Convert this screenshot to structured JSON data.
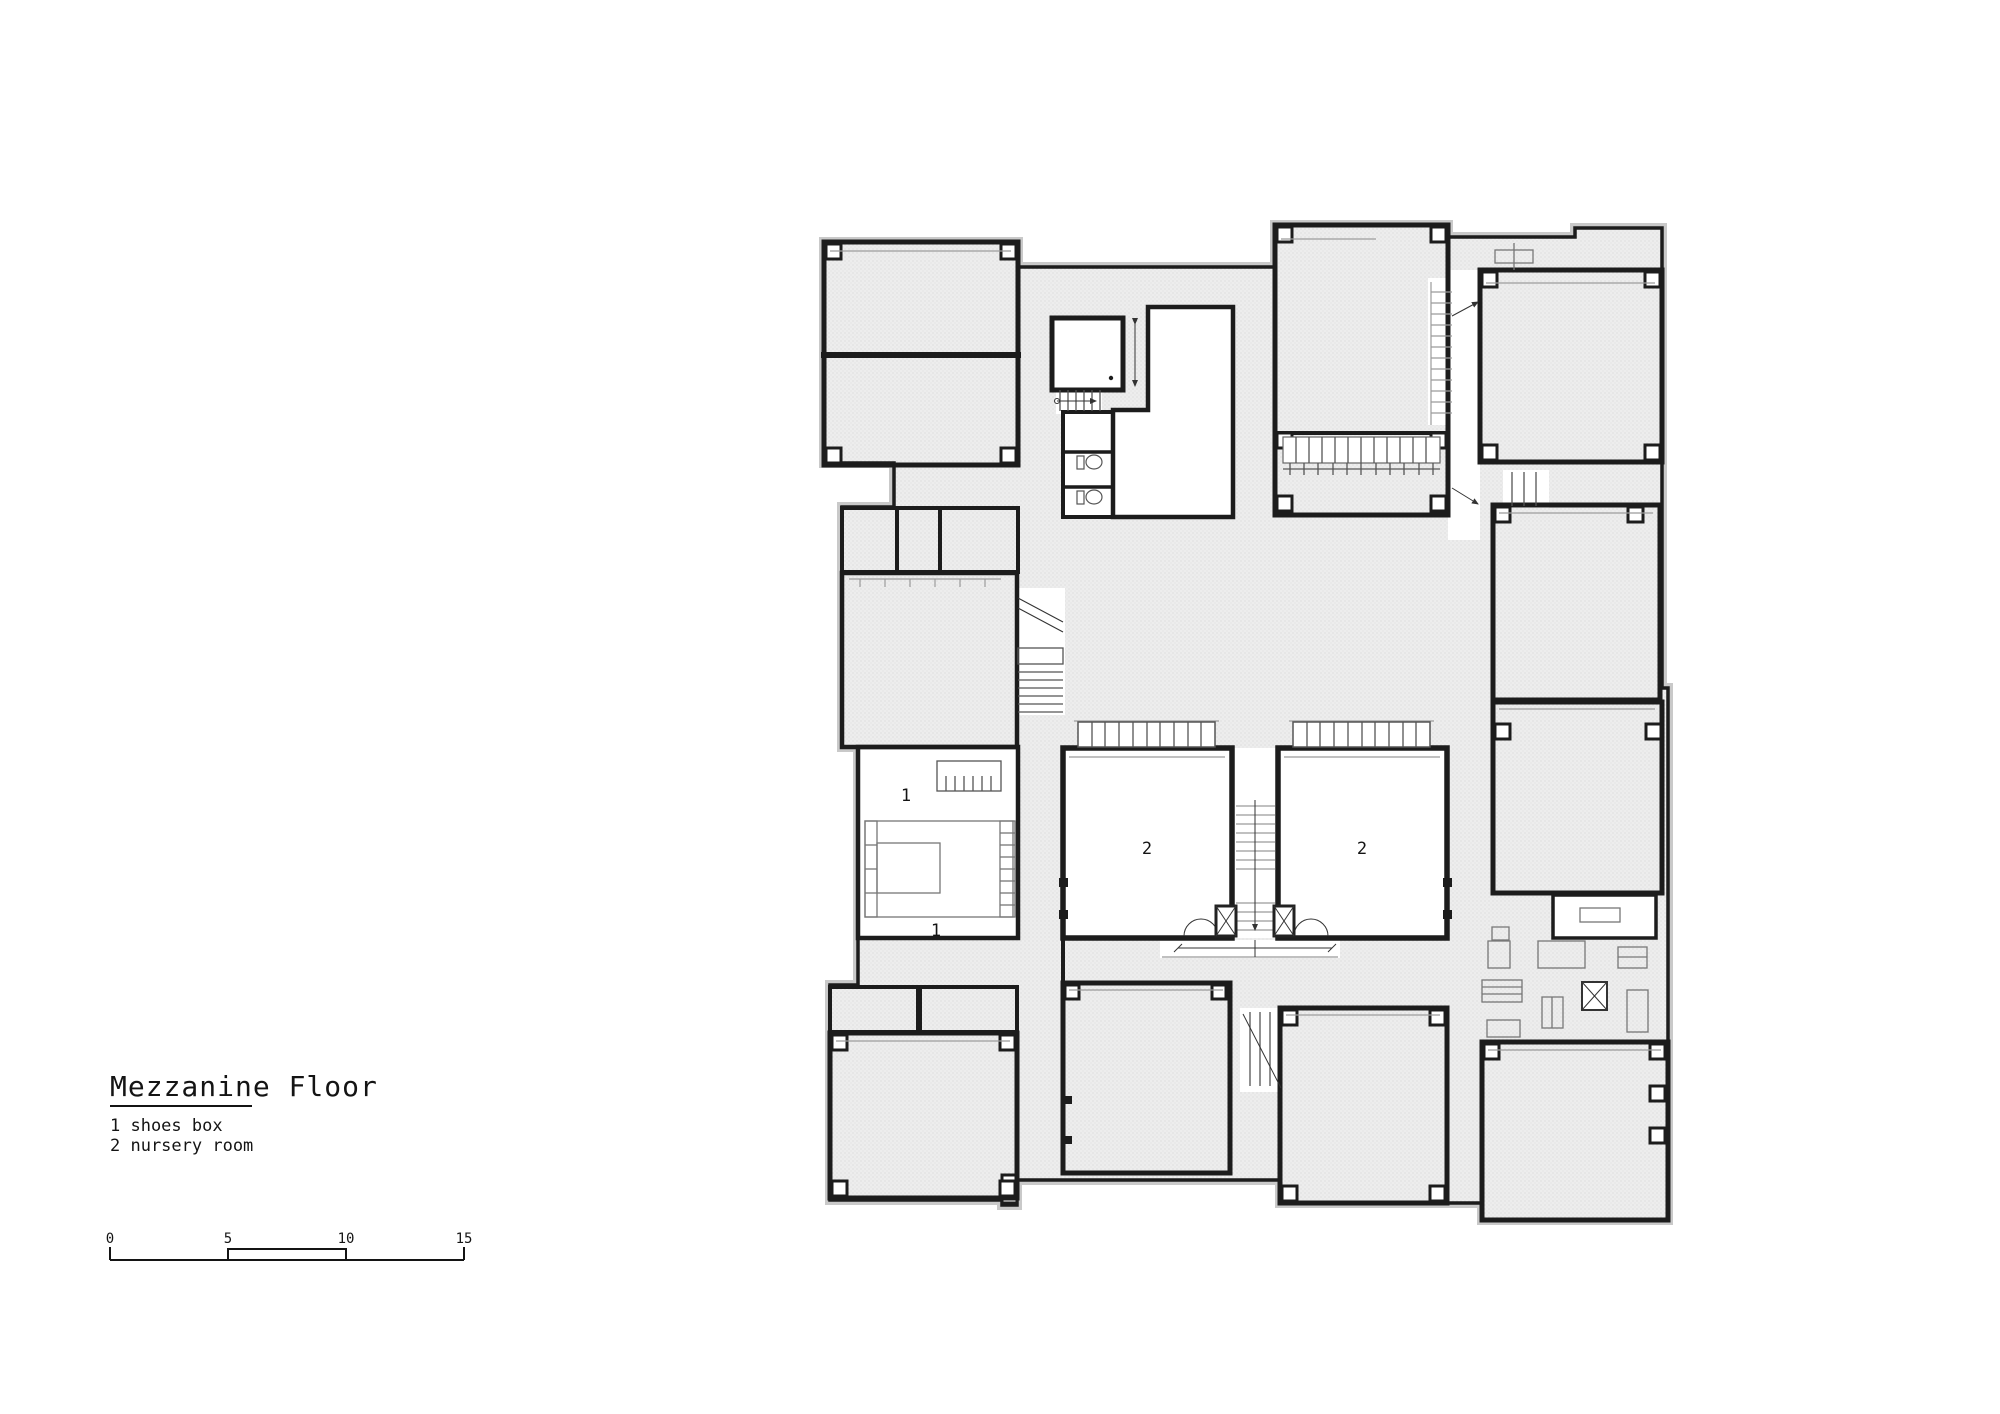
{
  "title": {
    "text": "Mezzanine Floor"
  },
  "legend": {
    "items": [
      "1 shoes box",
      "2 nursery room"
    ]
  },
  "scalebar": {
    "ticks": [
      "0",
      "5",
      "10",
      "15"
    ]
  },
  "plan": {
    "labels": {
      "shoes": "1",
      "nursery": "2"
    }
  },
  "colors": {
    "wall": "#1c1c1c",
    "hatch_bg": "#ededed",
    "hatch_dot": "#cdcdcd",
    "thin_line": "#9b9b9b",
    "paper": "#ffffff"
  }
}
